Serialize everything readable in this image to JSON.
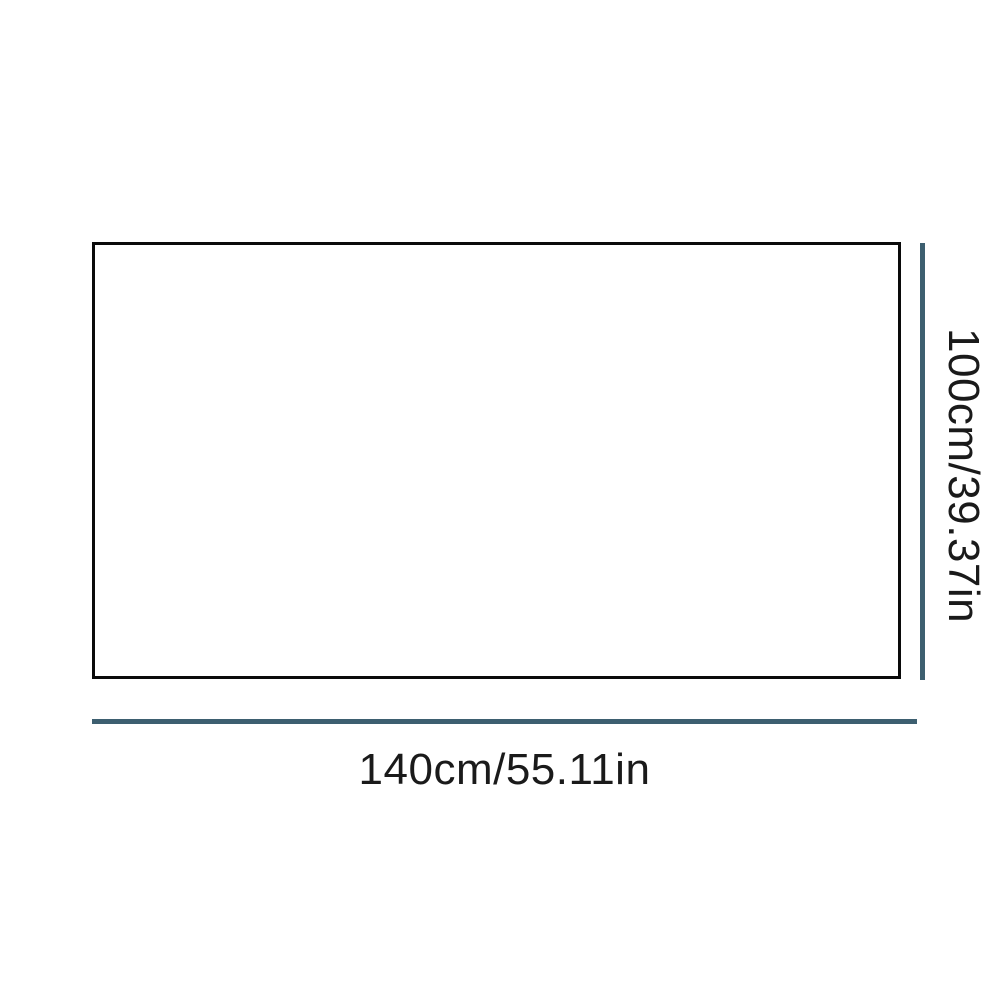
{
  "page": {
    "background": "#ffffff"
  },
  "diagram": {
    "type": "product-dimension-diagram",
    "product_rect": {
      "border_color": "#0a0a0a",
      "fill": "#ffffff"
    },
    "dimension_line_color": "#3d5f70",
    "text_color": "#1a1a1a",
    "width": {
      "label": "140cm/55.11in",
      "value_cm": 140,
      "value_in": 55.11
    },
    "height": {
      "label": "100cm/39.37in",
      "value_cm": 100,
      "value_in": 39.37
    }
  }
}
